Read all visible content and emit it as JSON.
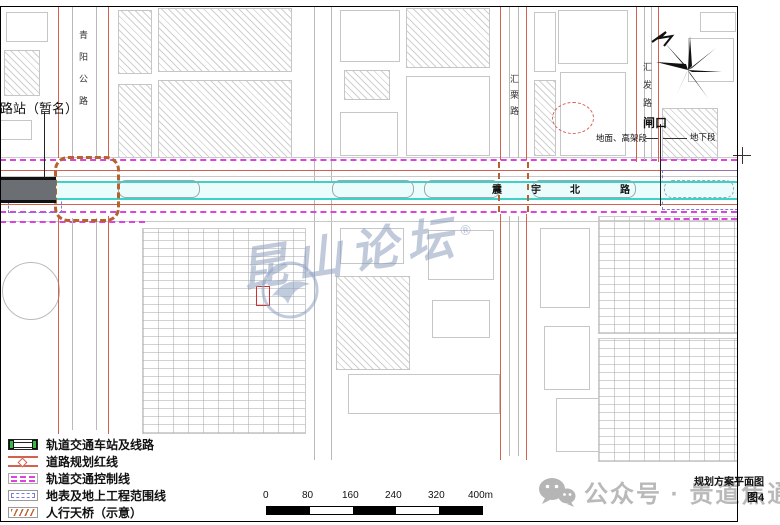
{
  "map": {
    "station_label": "路站（暂名）",
    "main_road": {
      "chars": [
        "震",
        "宇",
        "北",
        "路"
      ]
    },
    "roads": {
      "left_highway": "青阳公路",
      "middle_vertical": "汇栗路",
      "right_vertical": "汇发路"
    },
    "gate": {
      "label": "闸口",
      "left_section": "地面、高架段",
      "right_section": "地下段"
    },
    "watermark": {
      "text": "昆山论坛",
      "mark": "®"
    }
  },
  "legend": {
    "items": [
      {
        "label": "轨道交通车站及线路"
      },
      {
        "label": "道路规划红线"
      },
      {
        "label": "轨道交通控制线"
      },
      {
        "label": "地表及地上工程范围线"
      },
      {
        "label": "人行天桥（示意）"
      }
    ]
  },
  "scalebar": {
    "ticks": [
      "0",
      "80",
      "160",
      "240",
      "320",
      "400m"
    ]
  },
  "footer": {
    "title": "规划方案平面图",
    "figure": "图4",
    "watermark": "公众号 · 贵道焦通"
  },
  "colors": {
    "rail_cyan": "#3fd0c8",
    "red_line": "#d4604f",
    "control_magenta": "#dd44dd",
    "range_blue": "#7a7ae0",
    "bridge_orange": "#c06535",
    "station_green": "#33bb44",
    "watermark_blue": "#8fa2c4",
    "watermark_gray": "#b9b9b9"
  }
}
